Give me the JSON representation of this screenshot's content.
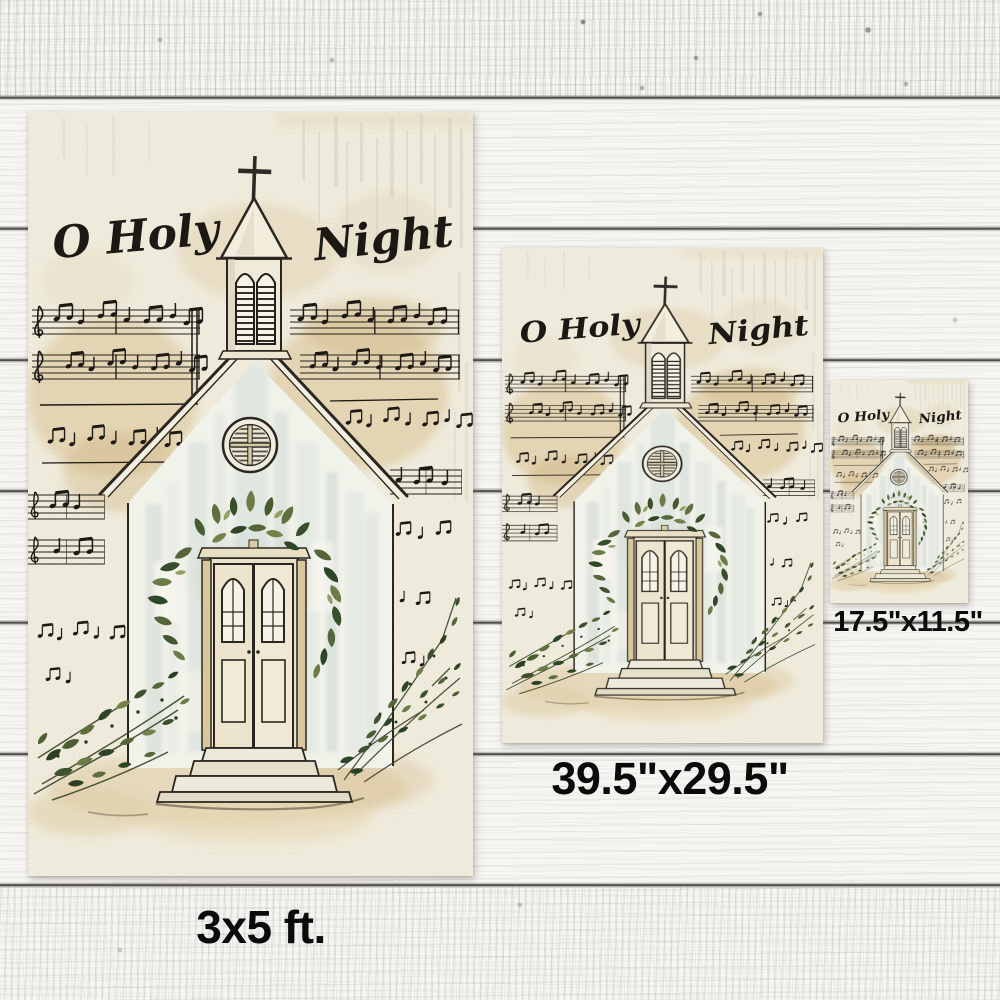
{
  "artwork": {
    "title_left": "O Holy",
    "title_right": "Night",
    "subject": "watercolor white church with cross steeple, garland over arched doors, greenery and sheet-music background"
  },
  "sizes": {
    "large": {
      "label": "3x5 ft."
    },
    "medium": {
      "label": "39.5\"x29.5\""
    },
    "small": {
      "label": "17.5\"x11.5\""
    }
  },
  "colors": {
    "wood_white": "#f6f5f2",
    "plank_seam": "#343230",
    "flag_canvas": "#f0ecdd",
    "watercolor_tan": "#d7bd8c",
    "wall_wash_blue": "#cdd9d3",
    "greenery_dark": "#2f4527",
    "greenery_light": "#6b7c46",
    "ink": "#1c1915",
    "label_text": "#0b0b0b"
  }
}
